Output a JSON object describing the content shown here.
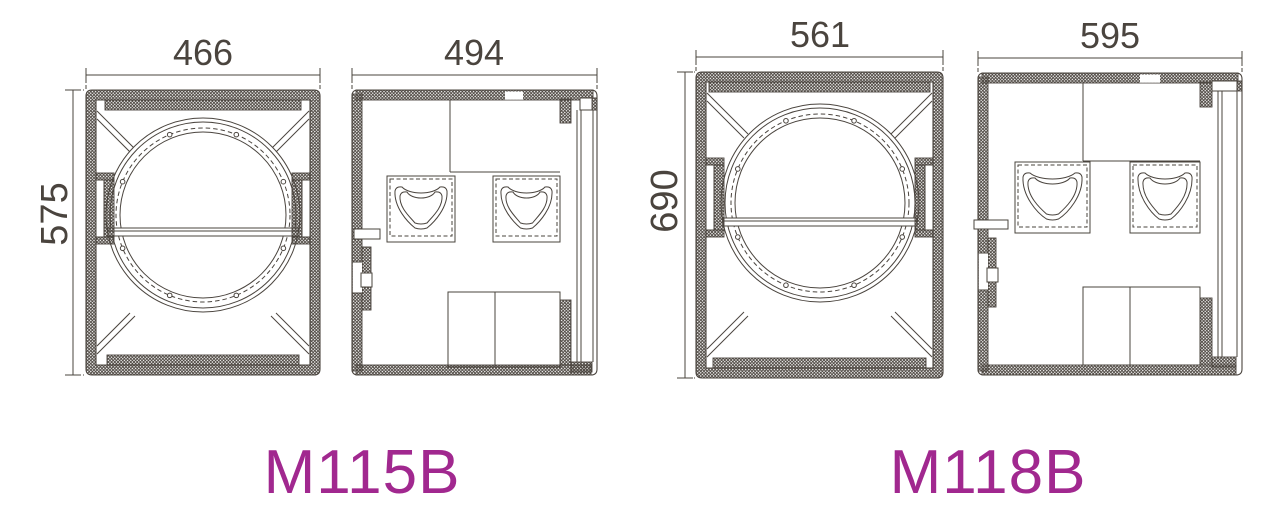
{
  "colors": {
    "line": "#4a443e",
    "accent": "#a1288f",
    "background": "#ffffff"
  },
  "models": {
    "m115b": {
      "label": "M115B",
      "front_width": "466",
      "front_height": "575",
      "side_width": "494"
    },
    "m118b": {
      "label": "M118B",
      "front_width": "561",
      "front_height": "690",
      "side_width": "595"
    }
  }
}
